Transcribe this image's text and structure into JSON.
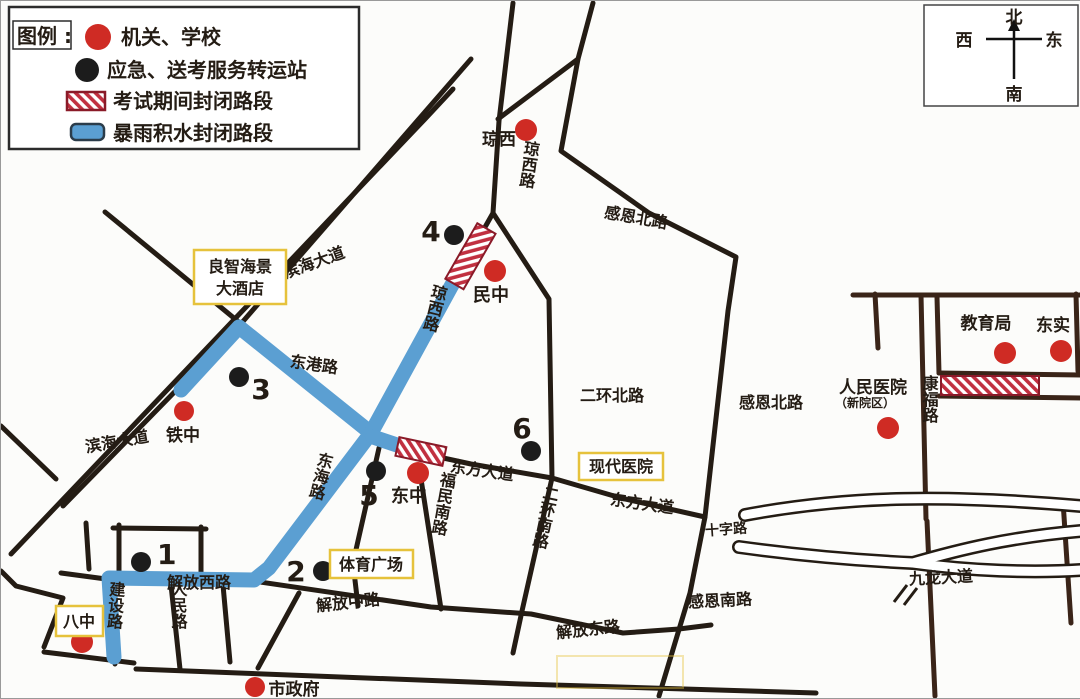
{
  "legend": {
    "title": "图例 :",
    "items": [
      {
        "symbol": "red-dot",
        "label": "机关、学校"
      },
      {
        "symbol": "black-dot",
        "label": "应急、送考服务转运站"
      },
      {
        "symbol": "hatched-road",
        "label": "考试期间封闭路段"
      },
      {
        "symbol": "flooded-road",
        "label": "暴雨积水封闭路段"
      }
    ]
  },
  "compass": {
    "north": "北",
    "west": "西",
    "east": "东",
    "south": "南"
  },
  "stations": [
    {
      "number": "1"
    },
    {
      "number": "2"
    },
    {
      "number": "3"
    },
    {
      "number": "4"
    },
    {
      "number": "5"
    },
    {
      "number": "6"
    }
  ],
  "places": {
    "qiongxi": "琼西",
    "minzhong": "民中",
    "tiezhong": "铁中",
    "dongzhong": "东中",
    "bazhong": "八中",
    "shizhengfu": "市政府",
    "jiaoyuju": "教育局",
    "dongshi": "东实",
    "renmin_hospital": "人民医院",
    "renmin_hospital_sub": "（新院区）"
  },
  "landmarks": {
    "hotel_line1": "良智海景",
    "hotel_line2": "大酒店",
    "modern_hospital": "现代医院",
    "sports_plaza": "体育广场"
  },
  "roads": {
    "binhai1": "滨海大道",
    "binhai2": "滨海大道",
    "donggang": "东港路",
    "qiongxi1": "琼西路",
    "qiongxi2": "琼西路",
    "donghai": "东海路",
    "ganen_n1": "感恩北路",
    "ganen_n2": "感恩北路",
    "erhuan_n": "二环北路",
    "erhuan_s": "二环南路",
    "fumin_s": "福民南路",
    "dongfang1": "东方大道",
    "dongfang2": "东方大道",
    "shizi": "十字路",
    "jiulong": "九龙大道",
    "kangfu": "康福路",
    "jiefang_w": "解放西路",
    "jiefang_m": "解放中路",
    "jiefang_e": "解放东路",
    "ganen_s": "感恩南路",
    "renmin": "人民路",
    "jianshe": "建设路"
  },
  "colors": {
    "flooded": "#5B9FD2",
    "closed_hatch": "#C13040",
    "closed_border": "#8A1A28",
    "red_dot": "#CF2B24",
    "black_dot": "#1C1C1C",
    "road": "#241C14",
    "landmark_border": "#E6C23C"
  }
}
